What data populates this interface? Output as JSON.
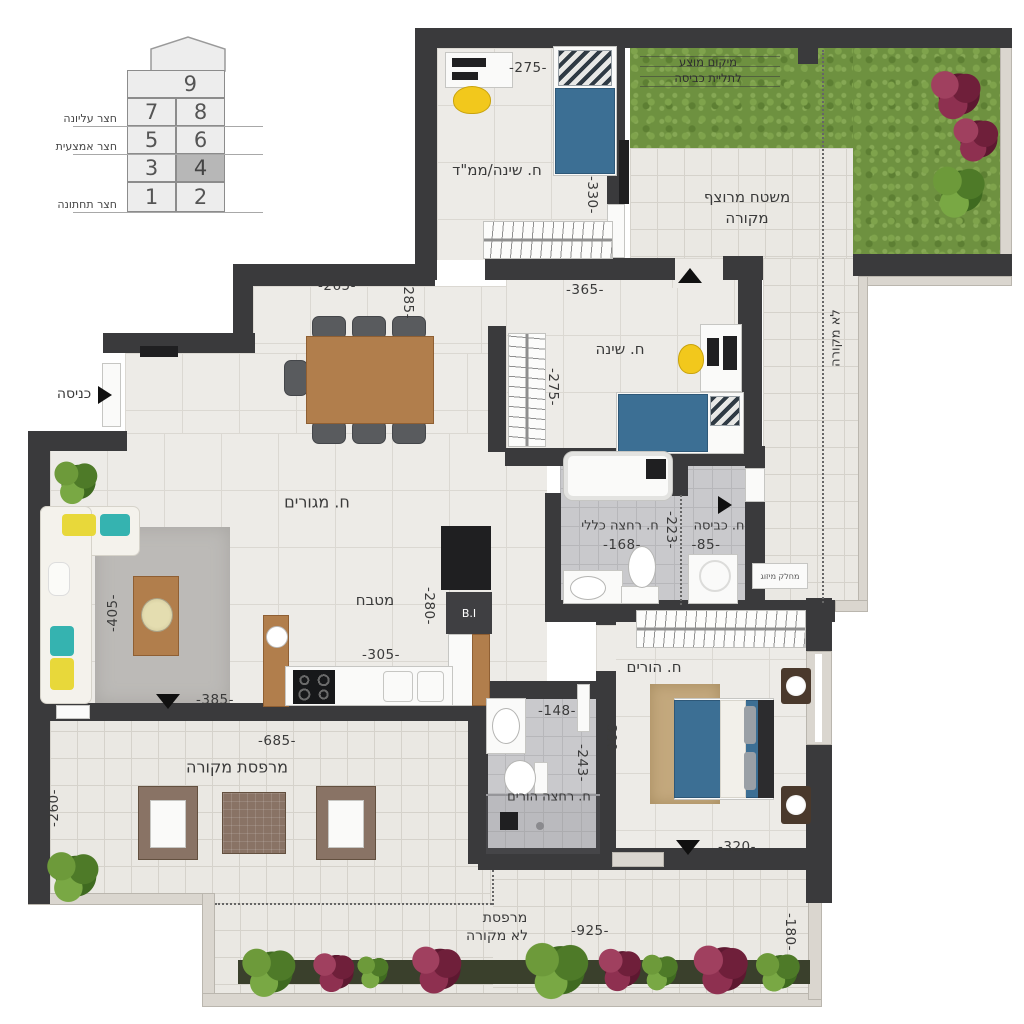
{
  "colors": {
    "wall": "#3a3a3c",
    "floor_tile": "#edebe7",
    "bath_tile": "#c9c9cc",
    "grass": "#6e9140",
    "bed_blue": "#3c6f94",
    "accent_yellow": "#f2c81c",
    "accent_teal": "#35b3b0",
    "wood": "#b17e4c"
  },
  "legend": {
    "units": [
      "9",
      "7",
      "8",
      "5",
      "6",
      "3",
      "4",
      "1",
      "2"
    ],
    "selected_unit": "4",
    "yards": [
      "חצר עליונה",
      "חצר אמצעית",
      "חצר תחתונה"
    ]
  },
  "rooms": {
    "safe_bedroom": "ח. שינה/ממ\"ד",
    "bedroom": "ח. שינה",
    "master_bedroom": "ח. הורים",
    "living": "ח. מגורים",
    "kitchen": "מטבח",
    "bathroom_general": "ח. רחצה כללי",
    "bathroom_master": "ח. רחצה הורים",
    "laundry": "ח. כביסה",
    "entrance": "כניסה",
    "terrace_covered": "מרפסת מקורה",
    "terrace_uncovered_1": "מרפסת",
    "terrace_uncovered_2": "לא מקורה",
    "paved_covered_1": "משטח מרוצף",
    "paved_covered_2": "מקורה",
    "uncovered_strip": "לא מקורה",
    "laundry_hint_1": "מיקום מוצע",
    "laundry_hint_2": "לתליית כביסה",
    "ac_divider": "מחלק מיזוג",
    "built_in": "B.I"
  },
  "dims": {
    "safe_w": "-275-",
    "safe_h": "-330-",
    "bedroom_w": "-365-",
    "bedroom_h": "-275-",
    "dining_w": "-265-",
    "dining_h": "-285-",
    "living_h": "-405-",
    "living_w": "-385-",
    "kitchen_h": "-280-",
    "kitchen_w": "-305-",
    "bath_w": "-168-",
    "hall_h": "-223-",
    "laundry_w": "-85-",
    "master_h": "-390-",
    "master_w": "-320-",
    "mbath_w": "-148-",
    "mbath_h": "-243-",
    "terrace_cov_w": "-685-",
    "terrace_cov_h": "-260-",
    "terrace_unc_w": "-925-",
    "terrace_unc_h": "-180-"
  }
}
